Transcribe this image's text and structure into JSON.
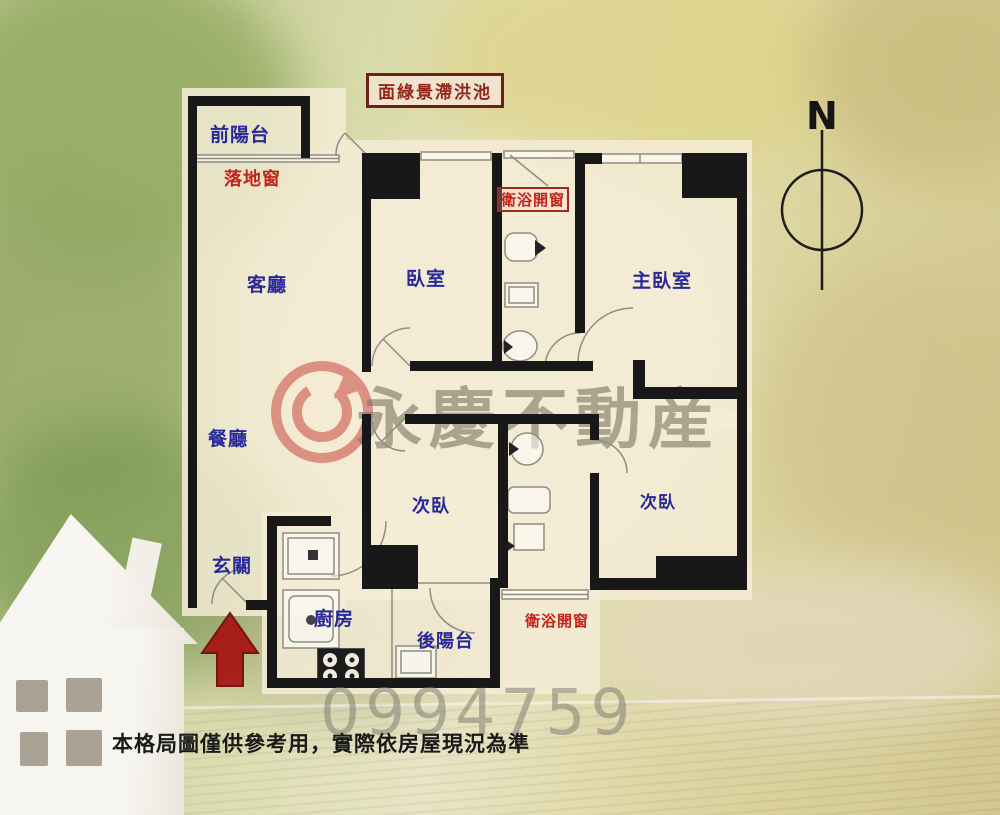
{
  "scene": {
    "pond_label": "面綠景滯洪池",
    "compass_n": "N",
    "disclaimer": "本格局圖僅供參考用，實際依房屋現況為準"
  },
  "rooms": {
    "front_balcony": "前陽台",
    "floor_window": "落地窗",
    "living": "客廳",
    "bedroom": "臥室",
    "bath_window_top": "衛浴開窗",
    "master_bedroom": "主臥室",
    "dining": "餐廳",
    "second_bedroom_left": "次臥",
    "second_bedroom_right": "次臥",
    "foyer": "玄關",
    "kitchen": "廚房",
    "rear_balcony": "後陽台",
    "bath_window_bottom": "衛浴開窗"
  },
  "watermark": {
    "brand": "永慶不動産",
    "number": "0994759"
  },
  "colors": {
    "room_label_blue": "#28289a",
    "annotation_red": "#c3231a",
    "pond_label_dark_red": "#93271c",
    "wall_black": "#181818",
    "arrow_red": "#a81713",
    "brand_watermark_gray": "#7a755d",
    "logo_watermark_red": "#cf5a50",
    "paper_cream": "#f4ecd6"
  }
}
